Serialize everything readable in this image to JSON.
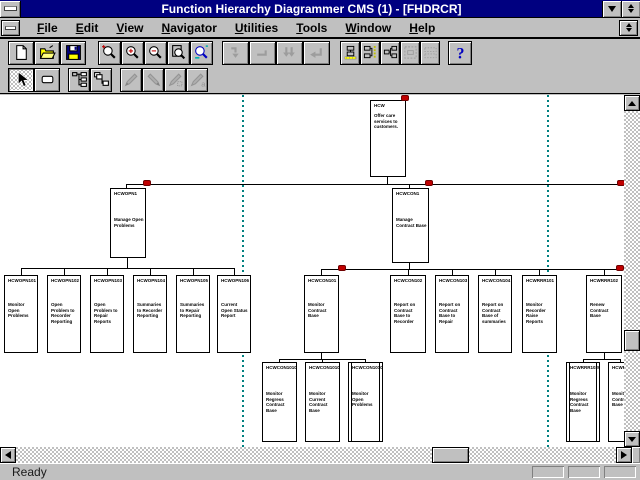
{
  "window": {
    "title": "Function Hierarchy Diagrammer  CMS (1) - [FHDRCR]",
    "status": "Ready"
  },
  "menu": {
    "items": [
      {
        "label": "File"
      },
      {
        "label": "Edit"
      },
      {
        "label": "View"
      },
      {
        "label": "Navigator"
      },
      {
        "label": "Utilities"
      },
      {
        "label": "Tools"
      },
      {
        "label": "Window"
      },
      {
        "label": "Help"
      }
    ]
  },
  "toolbar_row1": {
    "groups": [
      {
        "buttons": [
          {
            "name": "new-button",
            "icon": "new-icon",
            "enabled": true
          },
          {
            "name": "open-button",
            "icon": "open-icon",
            "enabled": true
          },
          {
            "name": "save-button",
            "icon": "save-icon",
            "enabled": true
          }
        ]
      },
      {
        "buttons": [
          {
            "name": "zoom-normal-button",
            "icon": "zoom-icon",
            "enabled": true
          },
          {
            "name": "zoom-in-button",
            "icon": "zoom-in-icon",
            "enabled": true
          },
          {
            "name": "zoom-out-button",
            "icon": "zoom-out-icon",
            "enabled": true
          },
          {
            "name": "zoom-page-button",
            "icon": "zoom-page-icon",
            "enabled": true
          },
          {
            "name": "zoom-fit-button",
            "icon": "zoom-fit-icon",
            "enabled": true
          }
        ]
      },
      {
        "buttons": [
          {
            "name": "nav-down-button",
            "icon": "nav-down-icon",
            "enabled": false
          },
          {
            "name": "nav-level-button",
            "icon": "nav-level-icon",
            "enabled": false
          },
          {
            "name": "nav-expand-button",
            "icon": "nav-double-icon",
            "enabled": false
          },
          {
            "name": "nav-return-button",
            "icon": "nav-corner-icon",
            "enabled": false
          }
        ]
      },
      {
        "buttons": [
          {
            "name": "layout-horizontal-button",
            "icon": "layout-ruler-h-icon",
            "enabled": true
          },
          {
            "name": "layout-vertical-button",
            "icon": "layout-ruler-v-icon",
            "enabled": true
          },
          {
            "name": "layout-compact-button",
            "icon": "layout-compact-icon",
            "enabled": true
          },
          {
            "name": "selection-frame-button",
            "icon": "frame-icon",
            "enabled": false
          },
          {
            "name": "resequence-button",
            "icon": "pattern-icon",
            "enabled": false
          }
        ]
      },
      {
        "buttons": [
          {
            "name": "help-button",
            "icon": "help-icon",
            "enabled": true
          }
        ]
      }
    ]
  },
  "toolbar_row2": {
    "groups": [
      {
        "buttons": [
          {
            "name": "select-tool-button",
            "icon": "pointer-icon",
            "enabled": true,
            "selected": true
          },
          {
            "name": "function-box-tool-button",
            "icon": "box-tool-icon",
            "enabled": true
          }
        ]
      },
      {
        "buttons": [
          {
            "name": "expand-hierarchy-button",
            "icon": "hier-expand-icon",
            "enabled": true
          },
          {
            "name": "collapse-hierarchy-button",
            "icon": "hier-collapse-icon",
            "enabled": true
          }
        ]
      },
      {
        "buttons": [
          {
            "name": "edit-function-button",
            "icon": "pen1-icon",
            "enabled": false
          },
          {
            "name": "edit-label-button",
            "icon": "pen2-icon",
            "enabled": false
          },
          {
            "name": "edit-color-button",
            "icon": "pen3-icon",
            "enabled": false
          },
          {
            "name": "edit-font-button",
            "icon": "pen4-icon",
            "enabled": false
          }
        ]
      }
    ]
  },
  "diagram": {
    "guides": [
      {
        "x": 242
      },
      {
        "x": 547
      }
    ],
    "nodes": [
      {
        "label": "HCW",
        "desc": "Offer care services to customers.",
        "x": 370,
        "y": 100,
        "w": 36,
        "h": 77,
        "level": 1,
        "double": false
      },
      {
        "label": "HCWOPN1",
        "desc": "Manage Open Problems",
        "x": 110,
        "y": 188,
        "w": 36,
        "h": 70,
        "level": 2,
        "double": false
      },
      {
        "label": "HCWCON1",
        "desc": "Manage Contract Base",
        "x": 392,
        "y": 188,
        "w": 37,
        "h": 75,
        "level": 2,
        "double": false
      },
      {
        "label": "HCWOPN101",
        "desc": "Monitor Open Problems",
        "x": 4,
        "y": 275,
        "w": 34,
        "h": 78,
        "level": 3,
        "double": false
      },
      {
        "label": "HCWOPN102",
        "desc": "Open Problem to Recorder Reporting",
        "x": 47,
        "y": 275,
        "w": 34,
        "h": 78,
        "level": 3,
        "double": false
      },
      {
        "label": "HCWOPN103",
        "desc": "Open Problem to Repair Reports",
        "x": 90,
        "y": 275,
        "w": 34,
        "h": 78,
        "level": 3,
        "double": false
      },
      {
        "label": "HCWOPN104",
        "desc": "Summaries to Recorder Reporting",
        "x": 133,
        "y": 275,
        "w": 34,
        "h": 78,
        "level": 3,
        "double": false
      },
      {
        "label": "HCWOPN105",
        "desc": "Summaries to Repair Reporting",
        "x": 176,
        "y": 275,
        "w": 34,
        "h": 78,
        "level": 3,
        "double": false
      },
      {
        "label": "HCWOPN106",
        "desc": "Current Open Status Report",
        "x": 217,
        "y": 275,
        "w": 34,
        "h": 78,
        "level": 3,
        "double": false
      },
      {
        "label": "HCWCON101",
        "desc": "Monitor Contract Base",
        "x": 304,
        "y": 275,
        "w": 35,
        "h": 78,
        "level": 3,
        "double": false
      },
      {
        "label": "HCWCON102",
        "desc": "Report on Contract Base to Recorder",
        "x": 390,
        "y": 275,
        "w": 36,
        "h": 78,
        "level": 3,
        "double": false
      },
      {
        "label": "HCWCON103",
        "desc": "Report on Contract Base to Repair",
        "x": 435,
        "y": 275,
        "w": 34,
        "h": 78,
        "level": 3,
        "double": false
      },
      {
        "label": "HCWCON104",
        "desc": "Report on Contract Base of summaries",
        "x": 478,
        "y": 275,
        "w": 34,
        "h": 78,
        "level": 3,
        "double": false
      },
      {
        "label": "HCWRRR101",
        "desc": "Monitor Recorder Raise Reports",
        "x": 522,
        "y": 275,
        "w": 35,
        "h": 78,
        "level": 3,
        "double": false
      },
      {
        "label": "HCWRRR102",
        "desc": "Renew Contract Base",
        "x": 586,
        "y": 275,
        "w": 36,
        "h": 78,
        "level": 3,
        "double": false
      },
      {
        "label": "HCWCON10101",
        "desc": "Monitor Regress Contract Base",
        "x": 262,
        "y": 362,
        "w": 35,
        "h": 80,
        "level": 4,
        "double": false
      },
      {
        "label": "HCWCON10102",
        "desc": "Monitor Current Contract Base",
        "x": 305,
        "y": 362,
        "w": 35,
        "h": 80,
        "level": 4,
        "double": false
      },
      {
        "label": "HCWCON10103",
        "desc": "Monitor Open Problems",
        "x": 348,
        "y": 362,
        "w": 35,
        "h": 80,
        "level": 4,
        "double": true
      },
      {
        "label": "HCWRRR10201",
        "desc": "Monitor Regress Contract Base",
        "x": 566,
        "y": 362,
        "w": 34,
        "h": 80,
        "level": 4,
        "double": true
      },
      {
        "label": "HCWRRR10202",
        "desc": "Monitor Contract Base",
        "x": 608,
        "y": 362,
        "w": 30,
        "h": 80,
        "level": 4,
        "double": false
      }
    ],
    "segments": [
      {
        "x": 387,
        "y": 177,
        "w": 1,
        "h": 8
      },
      {
        "x": 126,
        "y": 184,
        "w": 514,
        "h": 1
      },
      {
        "x": 126,
        "y": 184,
        "w": 1,
        "h": 5
      },
      {
        "x": 409,
        "y": 184,
        "w": 1,
        "h": 5
      },
      {
        "x": 127,
        "y": 258,
        "w": 1,
        "h": 11
      },
      {
        "x": 21,
        "y": 268,
        "w": 214,
        "h": 1
      },
      {
        "x": 21,
        "y": 268,
        "w": 1,
        "h": 8
      },
      {
        "x": 64,
        "y": 268,
        "w": 1,
        "h": 8
      },
      {
        "x": 107,
        "y": 268,
        "w": 1,
        "h": 8
      },
      {
        "x": 150,
        "y": 268,
        "w": 1,
        "h": 8
      },
      {
        "x": 193,
        "y": 268,
        "w": 1,
        "h": 8
      },
      {
        "x": 234,
        "y": 268,
        "w": 1,
        "h": 8
      },
      {
        "x": 409,
        "y": 263,
        "w": 1,
        "h": 7
      },
      {
        "x": 321,
        "y": 269,
        "w": 301,
        "h": 1
      },
      {
        "x": 321,
        "y": 269,
        "w": 1,
        "h": 7
      },
      {
        "x": 408,
        "y": 269,
        "w": 1,
        "h": 7
      },
      {
        "x": 452,
        "y": 269,
        "w": 1,
        "h": 7
      },
      {
        "x": 495,
        "y": 269,
        "w": 1,
        "h": 7
      },
      {
        "x": 539,
        "y": 269,
        "w": 1,
        "h": 7
      },
      {
        "x": 604,
        "y": 269,
        "w": 1,
        "h": 7
      },
      {
        "x": 321,
        "y": 353,
        "w": 1,
        "h": 7
      },
      {
        "x": 279,
        "y": 359,
        "w": 87,
        "h": 1
      },
      {
        "x": 279,
        "y": 359,
        "w": 1,
        "h": 4
      },
      {
        "x": 322,
        "y": 359,
        "w": 1,
        "h": 4
      },
      {
        "x": 365,
        "y": 359,
        "w": 1,
        "h": 4
      },
      {
        "x": 604,
        "y": 353,
        "w": 1,
        "h": 7
      },
      {
        "x": 583,
        "y": 359,
        "w": 38,
        "h": 1
      },
      {
        "x": 583,
        "y": 359,
        "w": 1,
        "h": 4
      },
      {
        "x": 620,
        "y": 359,
        "w": 1,
        "h": 4
      }
    ],
    "dots": [
      {
        "x": 401,
        "y": 95
      },
      {
        "x": 143,
        "y": 180
      },
      {
        "x": 425,
        "y": 180
      },
      {
        "x": 617,
        "y": 180
      },
      {
        "x": 338,
        "y": 265
      },
      {
        "x": 616,
        "y": 265
      }
    ]
  },
  "colors": {
    "titlebar": "#000080",
    "marker_red": "#c00000",
    "guide_teal": "#008080",
    "box_border": "#000000"
  }
}
